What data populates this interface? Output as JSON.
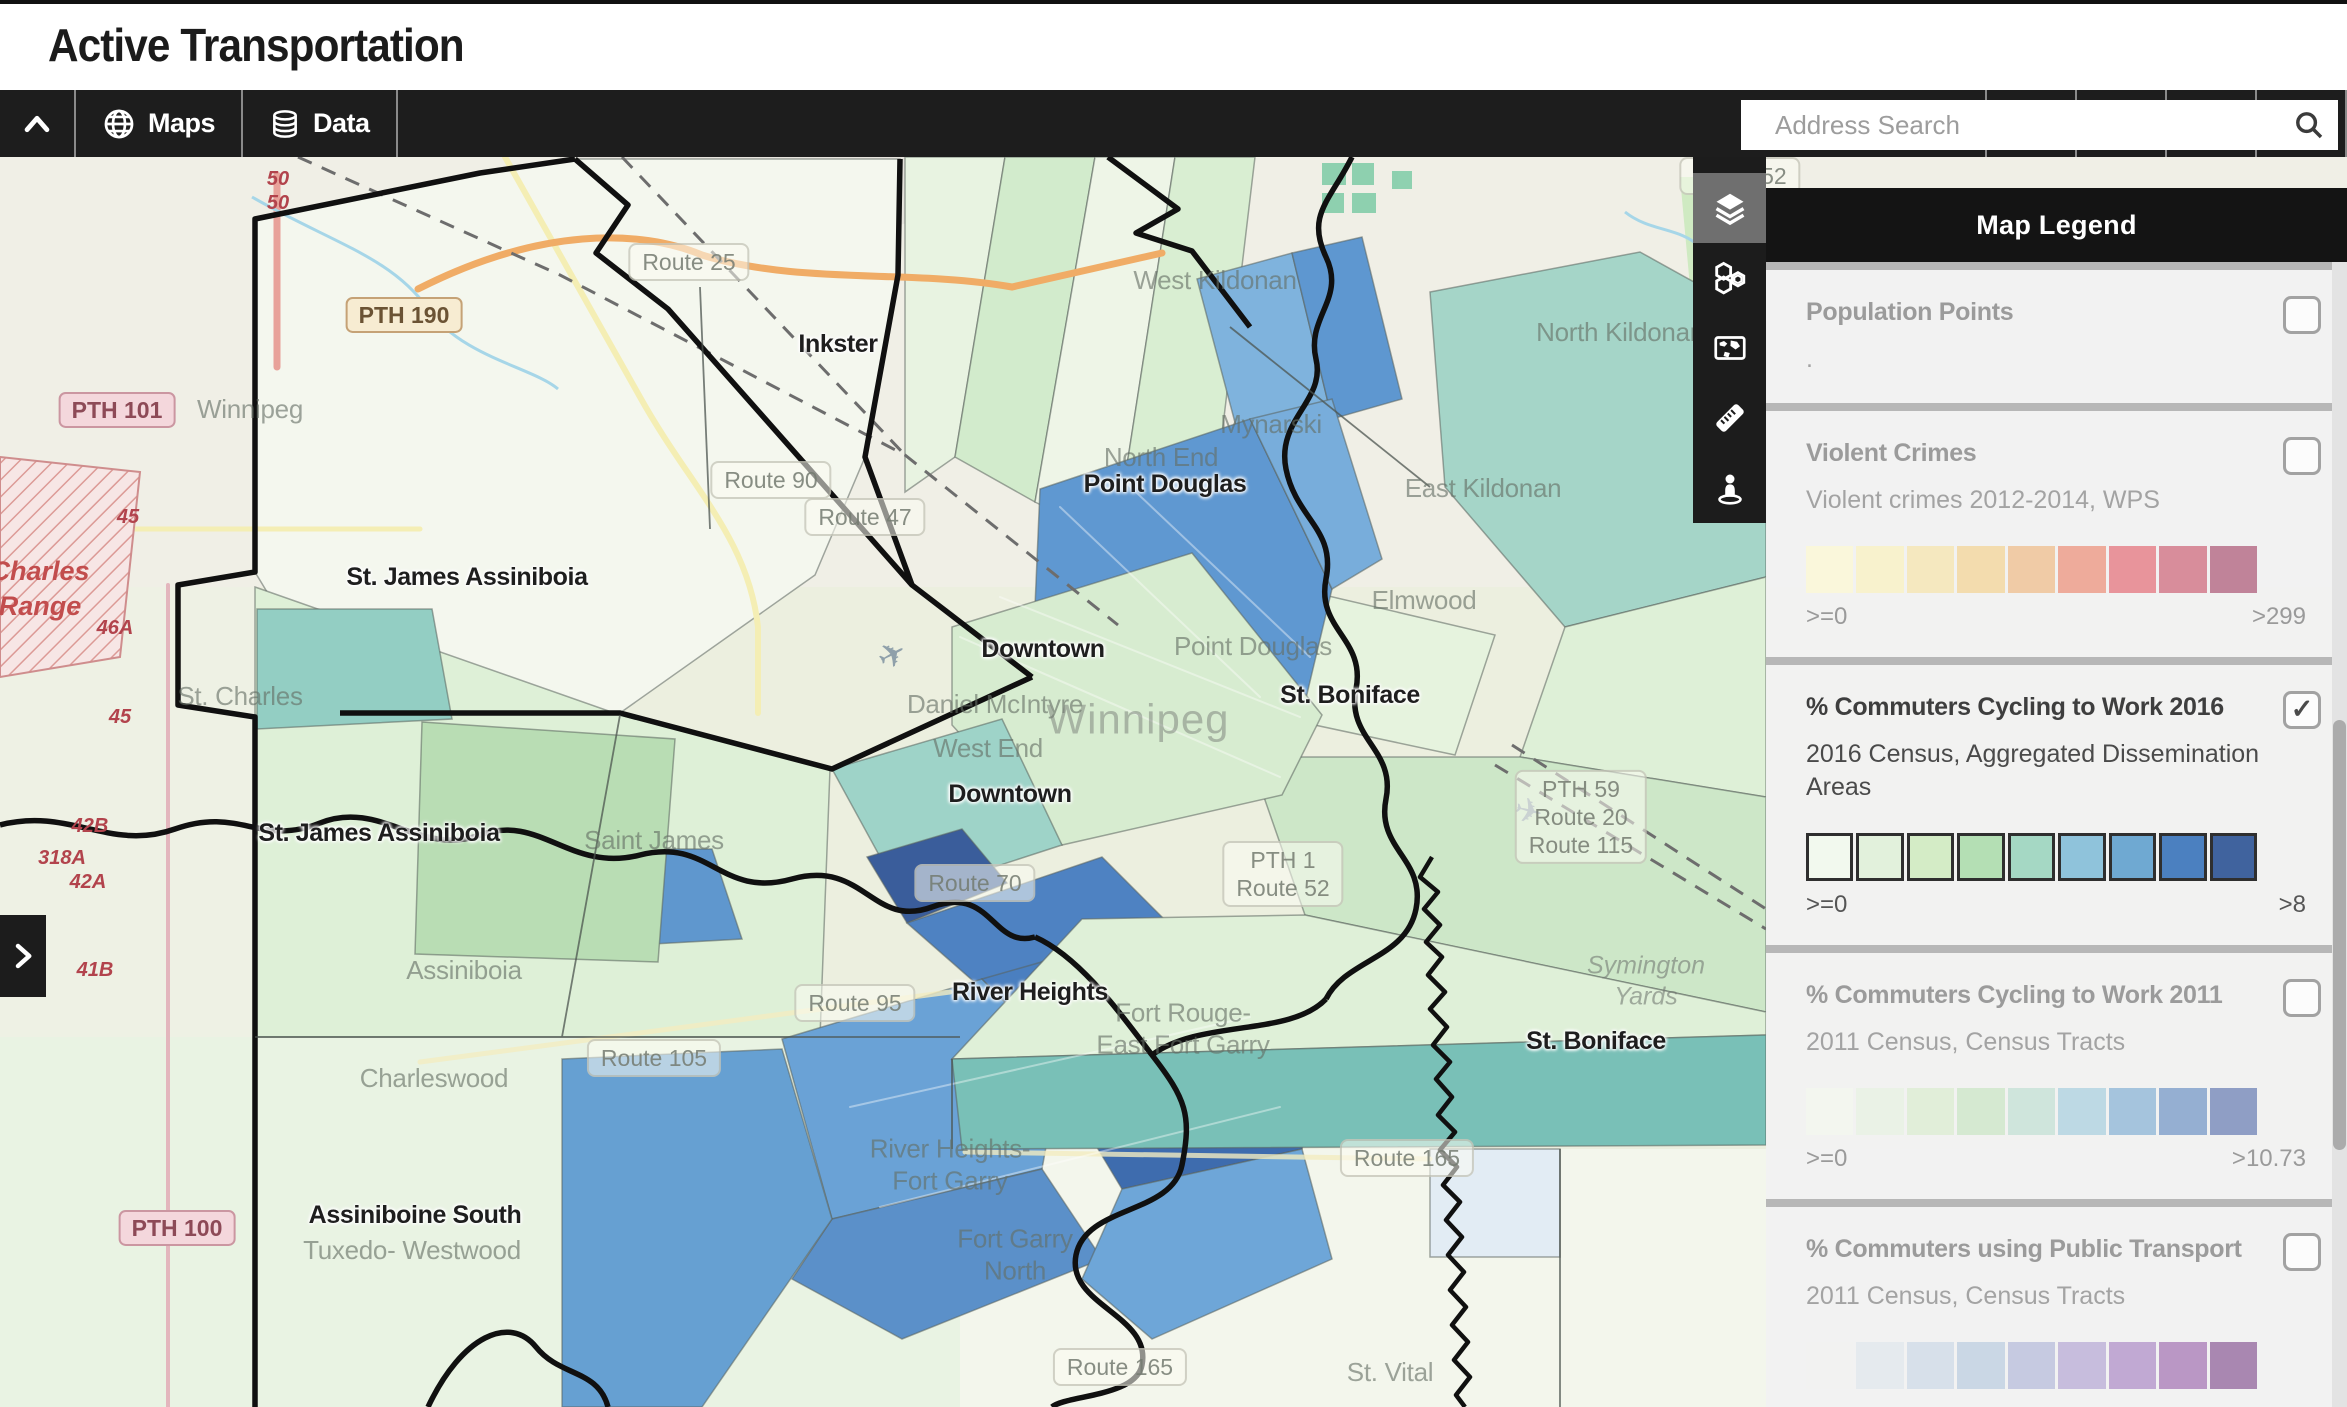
{
  "header": {
    "title": "Active Transportation"
  },
  "toolbar": {
    "maps_label": "Maps",
    "data_label": "Data",
    "search_placeholder": "Address Search"
  },
  "legend": {
    "title": "Map Legend",
    "sections": [
      {
        "id": "population-points",
        "title": "Population Points",
        "subtitle": ".",
        "checked": false,
        "swatches": [],
        "min": "",
        "max": ""
      },
      {
        "id": "violent-crimes",
        "title": "Violent Crimes",
        "subtitle": "Violent crimes 2012-2014, WPS",
        "checked": false,
        "min": ">=0",
        "max": ">299",
        "swatches": [
          "#faf7db",
          "#f8f2cd",
          "#f5e8bf",
          "#f3dcae",
          "#f0cba6",
          "#eeab9b",
          "#e8949b",
          "#d88d9b",
          "#c08399"
        ]
      },
      {
        "id": "cycling-2016",
        "title": "% Commuters Cycling to Work 2016",
        "subtitle": "2016 Census, Aggregated Dissemination Areas",
        "checked": true,
        "bordered": true,
        "min": ">=0",
        "max": ">8",
        "swatches": [
          "#f2f9ee",
          "#e2f1dc",
          "#d4ecc6",
          "#b4dfb4",
          "#a5d8c4",
          "#8fc3db",
          "#6fa9d2",
          "#4b80c0",
          "#40639e"
        ]
      },
      {
        "id": "cycling-2011",
        "title": "% Commuters Cycling to Work 2011",
        "subtitle": "2011 Census, Census Tracts",
        "checked": false,
        "min": ">=0",
        "max": ">10.73",
        "swatches": [
          "#f3f6ef",
          "#eaf2e6",
          "#e1eed9",
          "#d5e9d1",
          "#cfe5dc",
          "#bdd9e4",
          "#a5c4dd",
          "#95afd2",
          "#8f9ec5"
        ]
      },
      {
        "id": "public-transport",
        "title": "% Commuters using Public Transport",
        "subtitle": "2011 Census, Census Tracts",
        "checked": false,
        "min": "",
        "max": "",
        "swatches": [
          "#f2f2f1",
          "#e5eaee",
          "#d7e0ea",
          "#cad7e5",
          "#c6cae1",
          "#c7bddd",
          "#c1a9d3",
          "#ba97c5",
          "#a987b1"
        ]
      }
    ]
  },
  "map": {
    "labels": [
      {
        "t": "Inkster",
        "x": 838,
        "y": 187,
        "c": "ml-dark"
      },
      {
        "t": "Point Douglas",
        "x": 1165,
        "y": 327,
        "c": "ml-dark"
      },
      {
        "t": "St. James Assiniboia",
        "x": 467,
        "y": 420,
        "c": "ml-dark"
      },
      {
        "t": "Downtown",
        "x": 1043,
        "y": 492,
        "c": "ml-dark"
      },
      {
        "t": "St. Boniface",
        "x": 1350,
        "y": 538,
        "c": "ml-dark"
      },
      {
        "t": "Downtown",
        "x": 1010,
        "y": 637,
        "c": "ml-dark"
      },
      {
        "t": "St. James Assiniboia",
        "x": 379,
        "y": 676,
        "c": "ml-dark"
      },
      {
        "t": "River Heights",
        "x": 1030,
        "y": 835,
        "c": "ml-dark"
      },
      {
        "t": "St. Boniface",
        "x": 1596,
        "y": 884,
        "c": "ml-dark"
      },
      {
        "t": "Assiniboine South",
        "x": 415,
        "y": 1058,
        "c": "ml-dark"
      },
      {
        "t": "West Kildonan",
        "x": 1215,
        "y": 124,
        "c": "ml-f"
      },
      {
        "t": "North Kildonan",
        "x": 1620,
        "y": 176,
        "c": "ml-f"
      },
      {
        "t": "Mynarski",
        "x": 1271,
        "y": 268,
        "c": "ml-f"
      },
      {
        "t": "North End",
        "x": 1161,
        "y": 301,
        "c": "ml-f"
      },
      {
        "t": "East Kildonan",
        "x": 1483,
        "y": 332,
        "c": "ml-f"
      },
      {
        "t": "Elmwood",
        "x": 1424,
        "y": 444,
        "c": "ml-f"
      },
      {
        "t": "Point Douglas",
        "x": 1253,
        "y": 490,
        "c": "ml-f"
      },
      {
        "t": "Daniel McIntyre",
        "x": 995,
        "y": 548,
        "c": "ml-f"
      },
      {
        "t": "West End",
        "x": 988,
        "y": 592,
        "c": "ml-f"
      },
      {
        "t": "Saint James",
        "x": 654,
        "y": 684,
        "c": "ml-f"
      },
      {
        "t": "St. Charles",
        "x": 240,
        "y": 540,
        "c": "ml-f"
      },
      {
        "t": "Assiniboia",
        "x": 464,
        "y": 814,
        "c": "ml-f"
      },
      {
        "t": "Charleswood",
        "x": 434,
        "y": 922,
        "c": "ml-f"
      },
      {
        "t": "Tuxedo- Westwood",
        "x": 412,
        "y": 1094,
        "c": "ml-f"
      },
      {
        "t": "Fort Rouge-\nEast Fort Garry",
        "x": 1183,
        "y": 872,
        "c": "ml-f"
      },
      {
        "t": "River Heights-\nFort Garry",
        "x": 950,
        "y": 1008,
        "c": "ml-f"
      },
      {
        "t": "Fort Garry\nNorth",
        "x": 1015,
        "y": 1098,
        "c": "ml-f"
      },
      {
        "t": "St. Vital",
        "x": 1390,
        "y": 1216,
        "c": "ml-f"
      },
      {
        "t": "Winnipeg",
        "x": 1138,
        "y": 562,
        "c": "ml-city"
      },
      {
        "t": "Winnipeg",
        "x": 250,
        "y": 253,
        "c": "ml-f"
      },
      {
        "t": "Symington\nYards",
        "x": 1646,
        "y": 824,
        "c": "ml-rail"
      },
      {
        "t": "Route 25",
        "x": 689,
        "y": 105,
        "c": "ml-bf"
      },
      {
        "t": "Route 52",
        "x": 1740,
        "y": 19,
        "c": "ml-bf"
      },
      {
        "t": "Route 90",
        "x": 771,
        "y": 323,
        "c": "ml-bf"
      },
      {
        "t": "Route 47",
        "x": 865,
        "y": 360,
        "c": "ml-bf"
      },
      {
        "t": "Route 70",
        "x": 975,
        "y": 726,
        "c": "ml-bf"
      },
      {
        "t": "Route 95",
        "x": 855,
        "y": 846,
        "c": "ml-bf"
      },
      {
        "t": "PTH 1\nRoute 52",
        "x": 1283,
        "y": 717,
        "c": "ml-bf"
      },
      {
        "t": "PTH 59\nRoute 20\nRoute 115",
        "x": 1581,
        "y": 660,
        "c": "ml-bf"
      },
      {
        "t": "Route 105",
        "x": 654,
        "y": 901,
        "c": "ml-bf"
      },
      {
        "t": "Route 165",
        "x": 1407,
        "y": 1001,
        "c": "ml-bf"
      },
      {
        "t": "Route 165",
        "x": 1120,
        "y": 1210,
        "c": "ml-bf"
      },
      {
        "t": "PTH 190",
        "x": 404,
        "y": 158,
        "c": "ml-bt"
      },
      {
        "t": "PTH 101",
        "x": 117,
        "y": 253,
        "c": "ml-bp"
      },
      {
        "t": "PTH 100",
        "x": 177,
        "y": 1071,
        "c": "ml-bp"
      },
      {
        "t": "50",
        "x": 278,
        "y": 22,
        "c": "ml-r"
      },
      {
        "t": "50",
        "x": 278,
        "y": 46,
        "c": "ml-r"
      },
      {
        "t": "45",
        "x": 128,
        "y": 360,
        "c": "ml-r"
      },
      {
        "t": "46A",
        "x": 115,
        "y": 471,
        "c": "ml-r"
      },
      {
        "t": "45",
        "x": 120,
        "y": 560,
        "c": "ml-r"
      },
      {
        "t": "42B",
        "x": 90,
        "y": 669,
        "c": "ml-r"
      },
      {
        "t": "318A",
        "x": 62,
        "y": 701,
        "c": "ml-r"
      },
      {
        "t": "42A",
        "x": 88,
        "y": 725,
        "c": "ml-r"
      },
      {
        "t": "41B",
        "x": 95,
        "y": 813,
        "c": "ml-r"
      },
      {
        "t": "Charles\nRange",
        "x": 40,
        "y": 432,
        "c": "ml-ri"
      }
    ]
  }
}
